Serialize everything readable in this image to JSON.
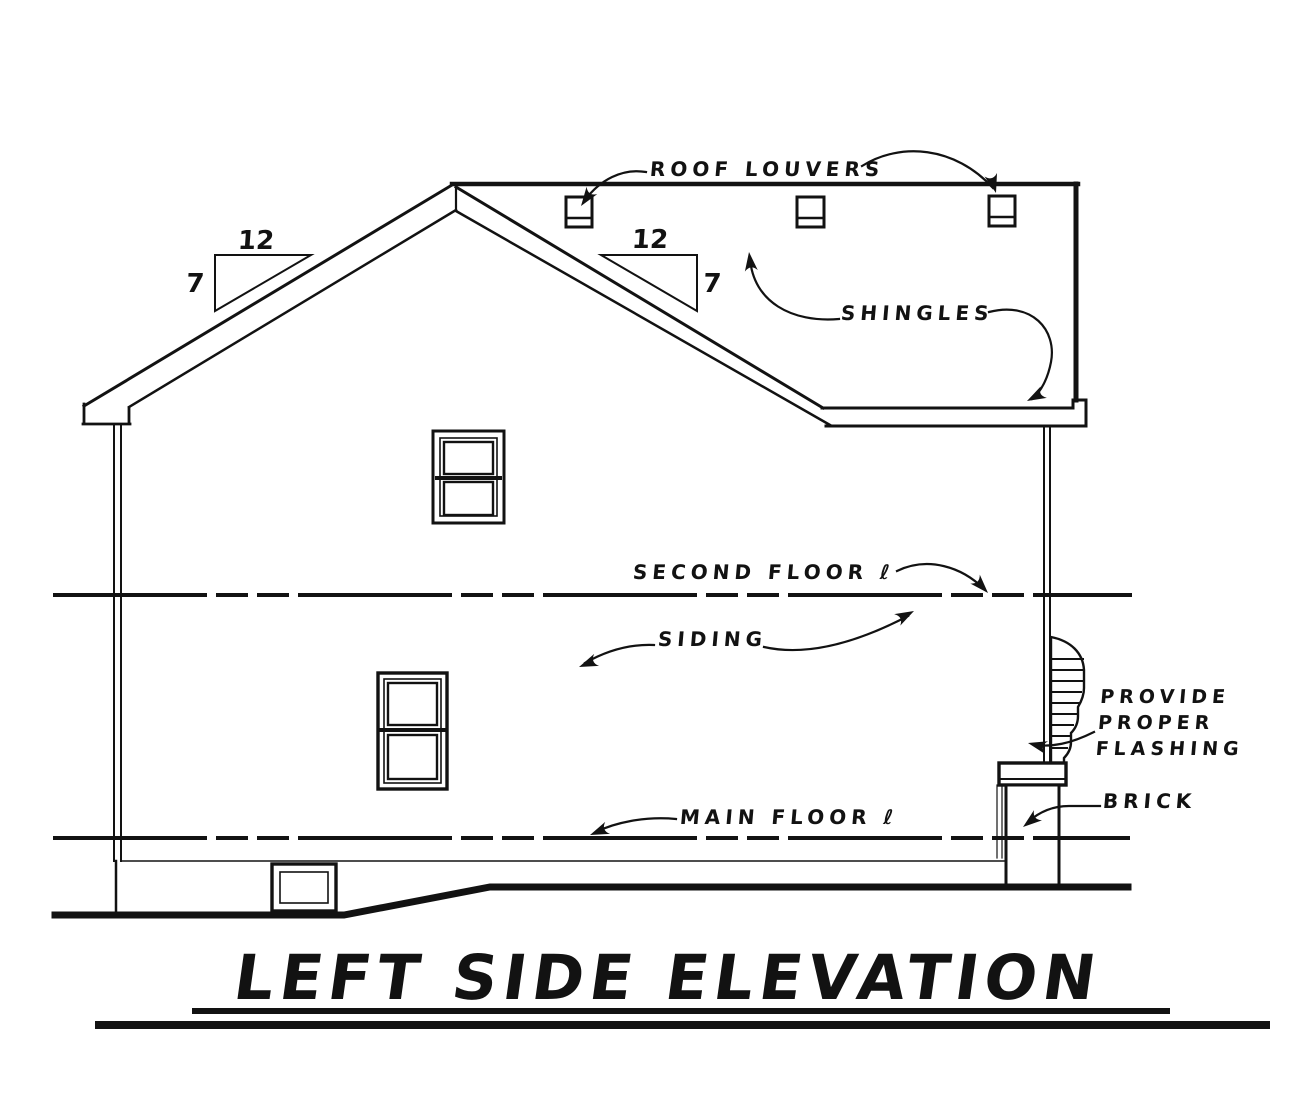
{
  "drawing": {
    "title": "LEFT SIDE ELEVATION",
    "labels": {
      "roof_louvers": "ROOF LOUVERS",
      "shingles": "SHINGLES",
      "second_floor": "SECOND FLOOR ℓ",
      "siding": "SIDING",
      "flashing_line1": "PROVIDE",
      "flashing_line2": "PROPER",
      "flashing_line3": "FLASHING",
      "brick": "BRICK",
      "main_floor": "MAIN FLOOR ℓ"
    },
    "slope": {
      "run": "12",
      "rise": "7"
    },
    "colors": {
      "ink": "#121212",
      "paper": "#ffffff"
    }
  }
}
